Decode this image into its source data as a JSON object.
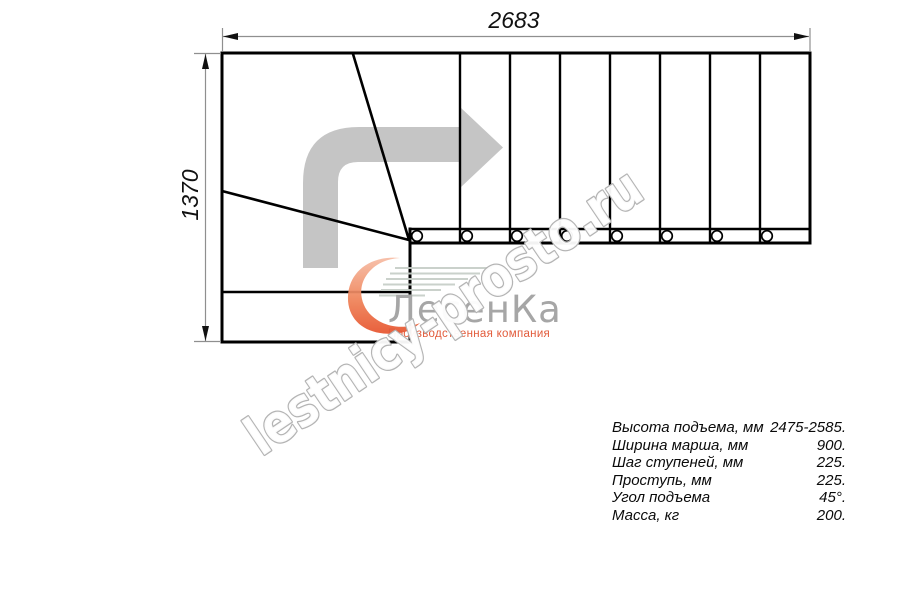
{
  "dimensions": {
    "width_label": "2683",
    "height_label": "1370"
  },
  "watermark": {
    "text": "lestnicy-prosto.ru"
  },
  "logo": {
    "company": "ЛесенКа",
    "tagline": "Производственная компания"
  },
  "specs": {
    "rows": [
      {
        "label": "Высота подъема, мм",
        "value": "2475-2585."
      },
      {
        "label": "Ширина марша, мм",
        "value": "900."
      },
      {
        "label": "Шаг ступеней, мм",
        "value": "225."
      },
      {
        "label": "Проступь, мм",
        "value": "225."
      },
      {
        "label": "Угол подъема",
        "value": "45°."
      },
      {
        "label": "Масса, кг",
        "value": "200."
      }
    ]
  },
  "icons": {
    "direction_arrow": "arrow-turn-up-right",
    "logo_swoosh": "flame-leaf-swoosh"
  },
  "colors": {
    "line_black": "#000000",
    "dimension_gray": "#8f8f8f",
    "arrow_gray": "#c5c5c5",
    "watermark_outline": "#b4b4b4",
    "logo_orange_dark": "#e7532d",
    "logo_orange_light": "#f7bca4",
    "logo_text_gray": "#a6a6a6",
    "logo_tagline_red": "#e25b3b",
    "hatch_green_gray": "#c6cec7"
  }
}
